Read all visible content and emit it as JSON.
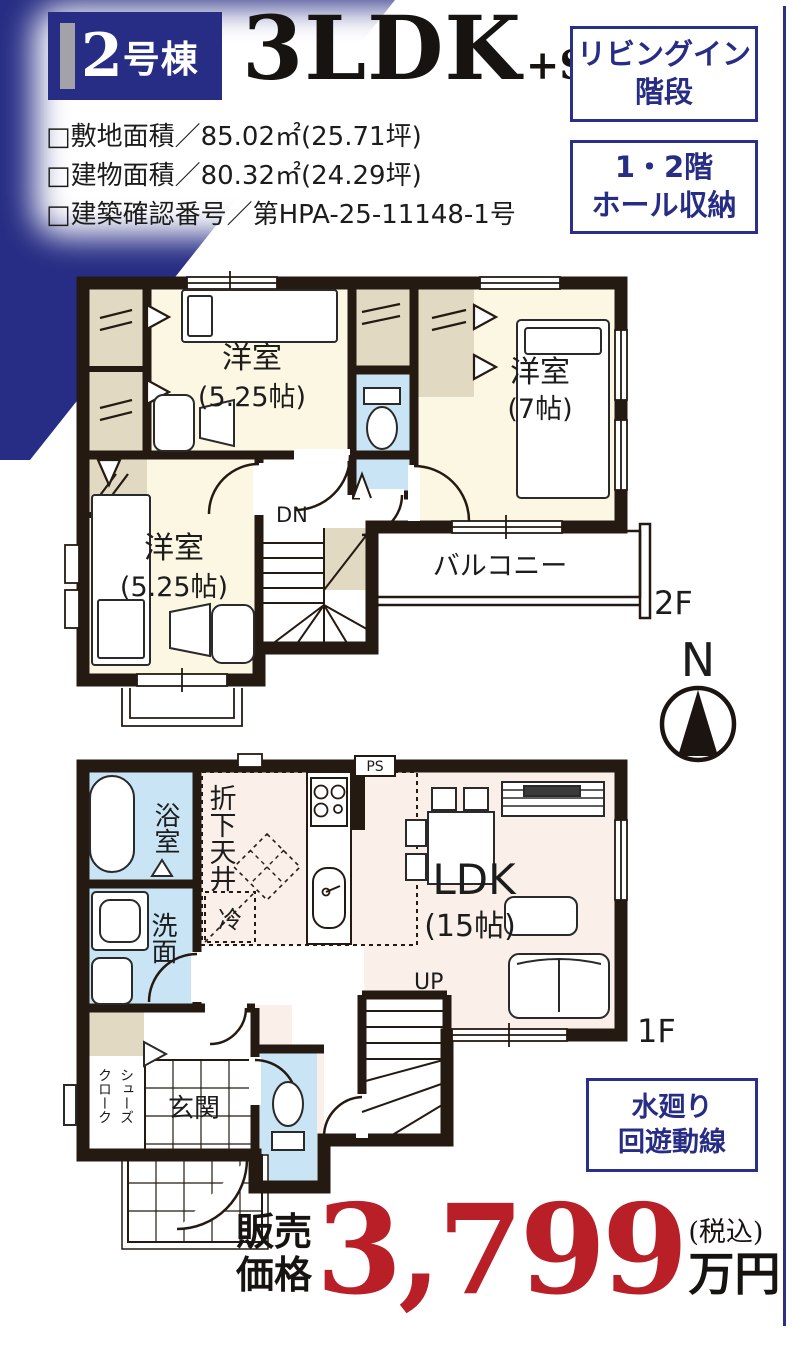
{
  "colors": {
    "navy": "#2A2F88",
    "red": "#B81F26",
    "wall": "#241A12",
    "cream": "#FBF7E3",
    "pink": "#FAF0E9",
    "wet_blue": "#C9E4F4",
    "closet_beige": "#E2D9C3"
  },
  "header": {
    "unit_number": "2",
    "unit_suffix": "号棟",
    "plan_type": "3LDK",
    "plan_suffix": "+SC",
    "spec_lines": [
      "□敷地面積／85.02㎡(25.71坪)",
      "□建物面積／80.32㎡(24.29坪)",
      "□建築確認番号／第HPA-25-11148-1号"
    ]
  },
  "feature_boxes": [
    {
      "line1": "リビングイン",
      "line2": "階段"
    },
    {
      "line1": "1・2階",
      "line2": "ホール収納"
    },
    {
      "line1": "水廻り",
      "line2": "回遊動線"
    }
  ],
  "compass": {
    "label": "N"
  },
  "floor2": {
    "floor_label": "2F",
    "bedroom1_name": "洋室",
    "bedroom1_size": "(5.25帖)",
    "bedroom2_name": "洋室",
    "bedroom2_size": "(7帖)",
    "bedroom3_name": "洋室",
    "bedroom3_size": "(5.25帖)",
    "balcony": "バルコニー",
    "stairs": "DN"
  },
  "floor1": {
    "floor_label": "1F",
    "bath": "浴室",
    "washroom": "洗面",
    "dropped_ceiling": "折下天井",
    "fridge": "冷",
    "pipe_space": "PS",
    "ldk_name": "LDK",
    "ldk_size": "(15帖)",
    "stairs": "UP",
    "entrance": "玄関",
    "shoe_closet_col_right": "シューズ",
    "shoe_closet_col_left": "クローク"
  },
  "price": {
    "label_line1": "販売",
    "label_line2": "価格",
    "amount": "3,799",
    "tax_note": "(税込)",
    "unit": "万円"
  }
}
